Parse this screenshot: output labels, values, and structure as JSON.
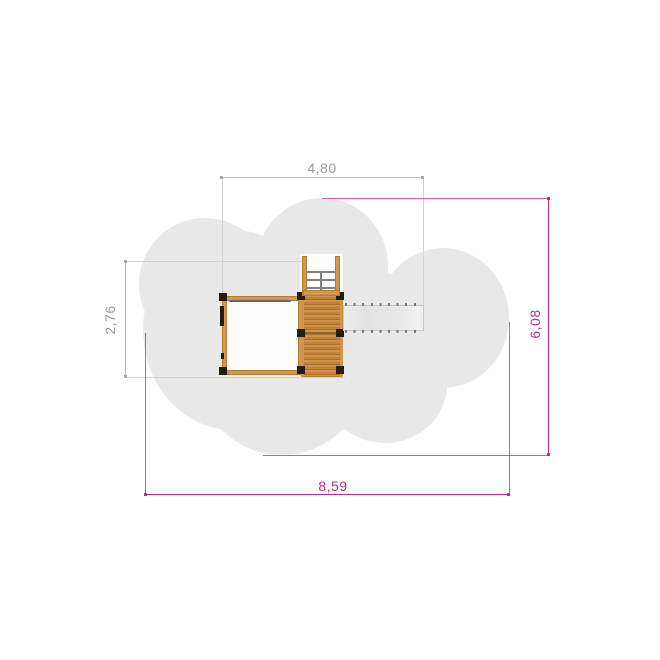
{
  "drawing": {
    "kind": "playground-equipment-plan-view",
    "components": [
      "safety-zone",
      "climbing-frame",
      "tower-platform",
      "entry-ladder",
      "slide"
    ]
  },
  "dimensions": {
    "equipment_width": {
      "label": "4,80",
      "orientation": "horizontal",
      "position": "top",
      "color_role": "gray"
    },
    "equipment_depth": {
      "label": "2,76",
      "orientation": "vertical",
      "position": "left",
      "color_role": "gray"
    },
    "safety_zone_depth": {
      "label": "6,08",
      "orientation": "vertical",
      "position": "right",
      "color_role": "magenta"
    },
    "safety_zone_width": {
      "label": "8,59",
      "orientation": "horizontal",
      "position": "bottom",
      "color_role": "magenta"
    }
  },
  "colors": {
    "safety_zone": "#e8e8e8",
    "dim_gray_text": "#9a9a9a",
    "dim_gray_line": "#bdbdbd",
    "dim_gray_ext": "#d2d2d2",
    "dim_magenta": "#b82e82",
    "wood_beam": "#d09750",
    "wood_beam_edge": "#b07c30",
    "wood_deck_light": "#cd9349",
    "wood_deck": "#c18238",
    "wood_deck_dark": "#a96f2e",
    "post": "#241c11",
    "metal": "#808080",
    "slide_fill": "#e9e9e9",
    "slide_edge": "#c6c6c6",
    "paper": "#ffffff"
  }
}
